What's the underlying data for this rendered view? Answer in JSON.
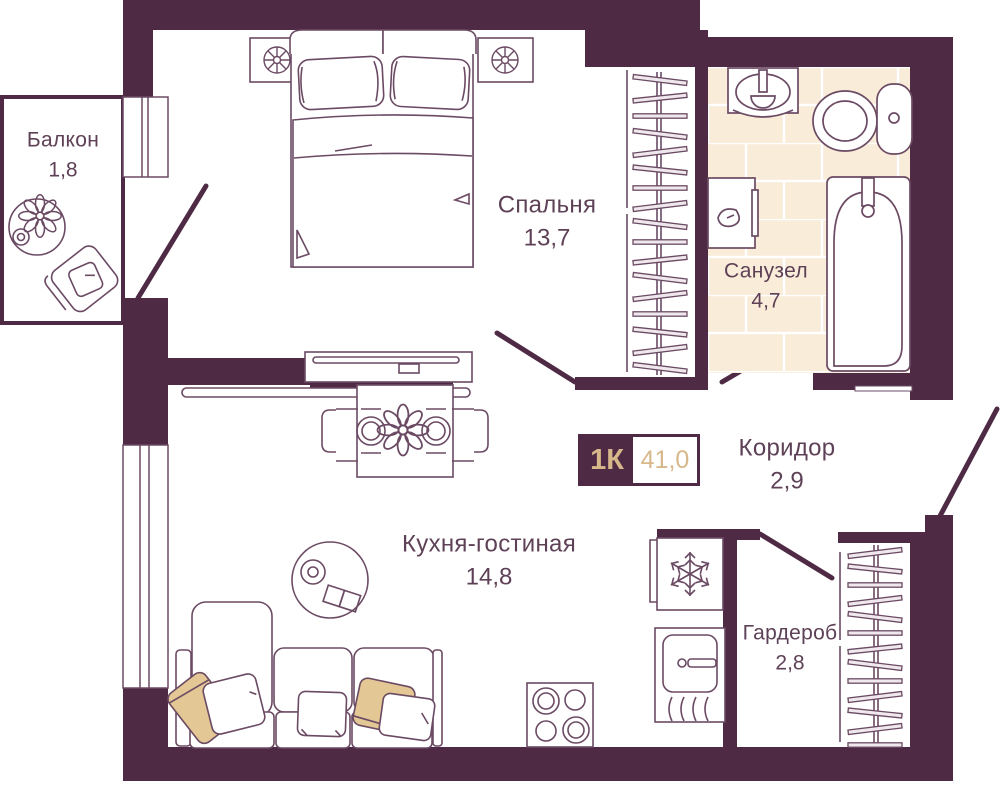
{
  "badge": {
    "type": "1К",
    "area": "41,0"
  },
  "rooms": {
    "balcony": {
      "name": "Балкон",
      "area": "1,8"
    },
    "bedroom": {
      "name": "Спальня",
      "area": "13,7"
    },
    "bathroom": {
      "name": "Санузел",
      "area": "4,7"
    },
    "corridor": {
      "name": "Коридор",
      "area": "2,9"
    },
    "kitchen_living": {
      "name": "Кухня-гостиная",
      "area": "14,8"
    },
    "wardrobe": {
      "name": "Гардероб",
      "area": "2,8"
    }
  },
  "colors": {
    "wall": "#4e2a45",
    "accent_tan": "#d7b88b",
    "tile_floor": "#f9ecd9",
    "furniture_line": "#6b4a63",
    "label_text": "#5e4156",
    "pillow_tan": "#e3c795"
  },
  "icons": [
    "double-bed",
    "bedside-lamp",
    "wardrobe-hanger-rack",
    "tv",
    "tv-console",
    "dining-table",
    "plate",
    "flower-centerpiece",
    "coffee-table",
    "corner-sofa",
    "pillow",
    "stove-burners",
    "kitchen-sink",
    "fridge-snowflake",
    "bath-sink",
    "toilet",
    "washing-machine",
    "bathtub",
    "door-swing",
    "window",
    "balcony-armchair",
    "balcony-plant-table"
  ]
}
